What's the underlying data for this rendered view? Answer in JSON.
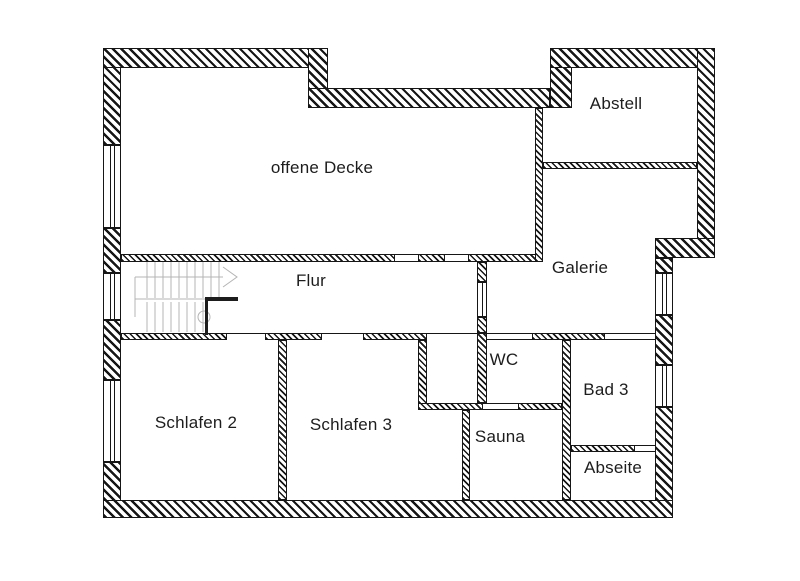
{
  "plan": {
    "background": "#ffffff",
    "wall_color": "#161616",
    "stair_color": "#b4b4b4",
    "rooms": [
      {
        "id": "offene-decke",
        "label": "offene Decke"
      },
      {
        "id": "abstell",
        "label": "Abstell"
      },
      {
        "id": "flur",
        "label": "Flur"
      },
      {
        "id": "galerie",
        "label": "Galerie"
      },
      {
        "id": "wc",
        "label": "WC"
      },
      {
        "id": "bad-3",
        "label": "Bad 3"
      },
      {
        "id": "schlafen-2",
        "label": "Schlafen 2"
      },
      {
        "id": "schlafen-3",
        "label": "Schlafen 3"
      },
      {
        "id": "sauna",
        "label": "Sauna"
      },
      {
        "id": "abseite",
        "label": "Abseite"
      }
    ]
  }
}
